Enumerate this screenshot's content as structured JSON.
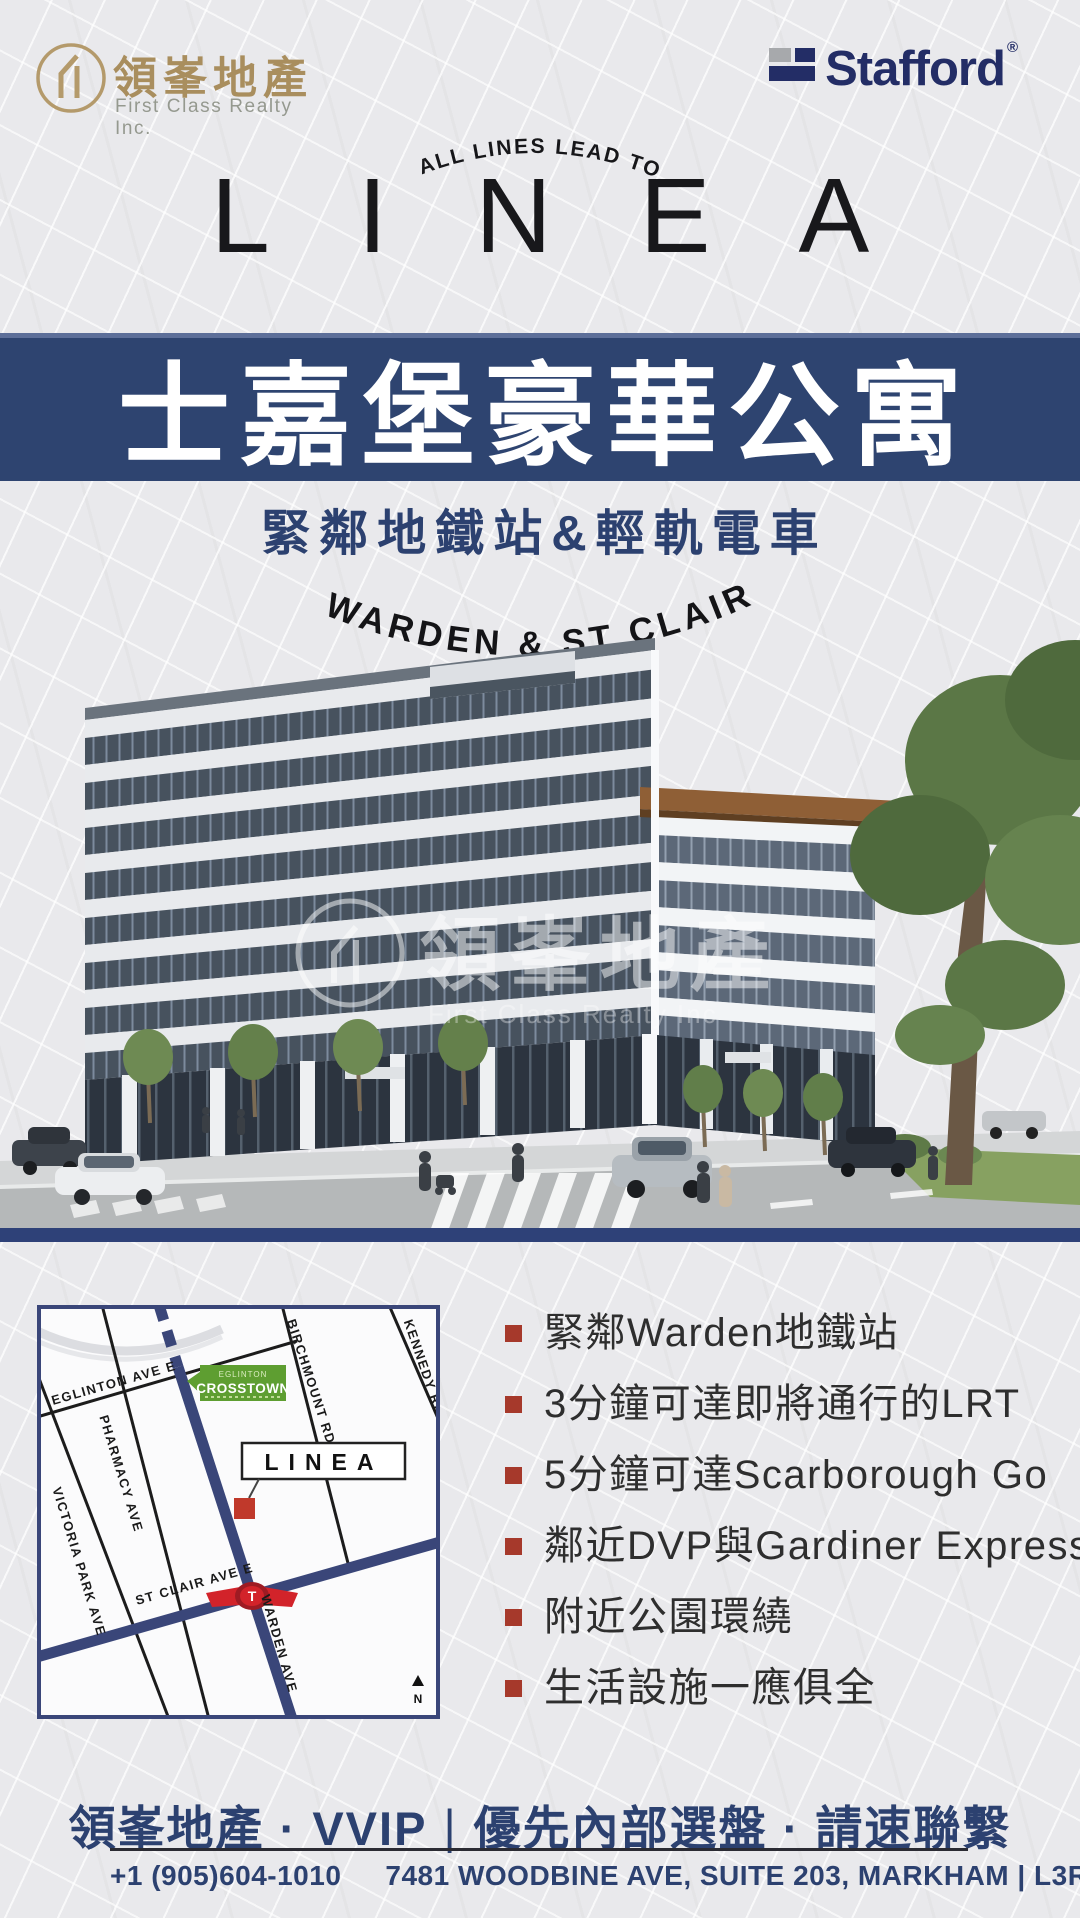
{
  "header": {
    "first_class": {
      "name_zh": "領峯地產",
      "name_en": "First Class Realty Inc.",
      "gold": "#a98e5e"
    },
    "stafford": {
      "name": "Stafford",
      "reg": "®",
      "navy": "#232d66"
    }
  },
  "hero": {
    "tagline": "ALL LINES LEAD TO",
    "title": "LINEA",
    "banner": "士嘉堡豪華公寓",
    "banner_color": "#2e4470",
    "subtitle": "緊鄰地鐵站&輕軌電車",
    "location_arc": "WARDEN & ST CLAIR"
  },
  "rendering": {
    "watermark_zh": "領峯地產",
    "watermark_en": "First Class Realty Inc"
  },
  "map": {
    "streets": {
      "eglinton": "EGLINTON AVE E",
      "pharmacy": "PHARMACY AVE",
      "victoria_park": "VICTORIA PARK AVE",
      "birchmount": "BIRCHMOUNT RD",
      "kennedy": "KENNEDY RD",
      "st_clair": "ST CLAIR AVE E",
      "warden": "WARDEN AVE"
    },
    "badge": {
      "small": "EGLINTON",
      "main": "CROSSTOWN",
      "green": "#5e9e31"
    },
    "site_label": "LINEA",
    "site_marker_color": "#c0392b",
    "north": "N",
    "ttc": "T"
  },
  "features": {
    "bullet_color": "#a6392b",
    "items": [
      "緊鄰Warden地鐵站",
      "3分鐘可達即將通行的LRT",
      "5分鐘可達Scarborough Go",
      "鄰近DVP與Gardiner Expressway",
      "附近公園環繞",
      "生活設施一應俱全"
    ]
  },
  "cta": {
    "left": "領峯地產 · VVIP",
    "separator": "|",
    "right": "優先內部選盤 · 請速聯繫"
  },
  "footer": {
    "phone": "+1 (905)604-1010",
    "address": "7481 WOODBINE AVE, SUITE 203, MARKHAM | L3R 2W1"
  }
}
